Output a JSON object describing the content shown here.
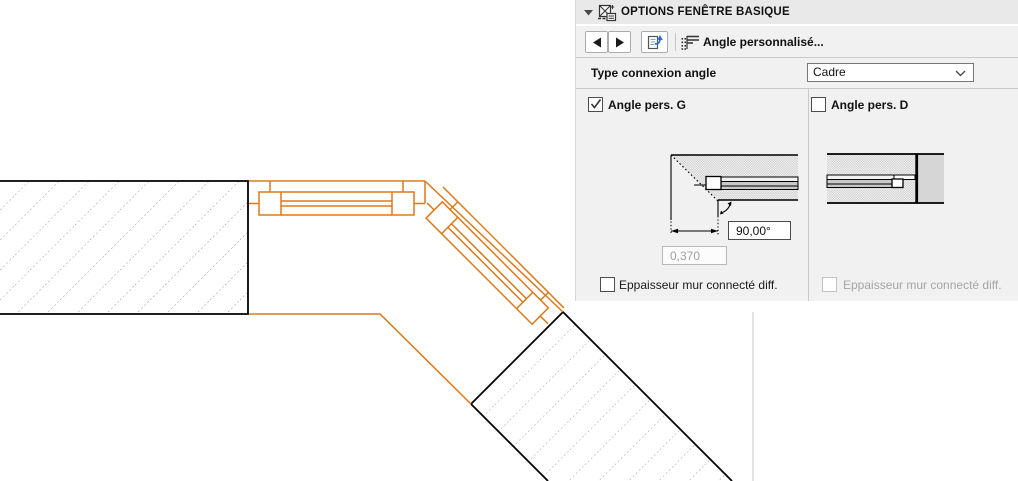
{
  "panel": {
    "header": {
      "title": "OPTIONS FENÊTRE BASIQUE"
    },
    "toolbar": {
      "prev_icon": "arrow-left-icon",
      "next_icon": "arrow-right-icon",
      "transfer_icon": "transfer-parameters-icon",
      "mode_icon": "custom-angle-icon",
      "mode_label": "Angle personnalisé..."
    },
    "connection": {
      "label": "Type connexion angle",
      "value": "Cadre"
    },
    "left_column": {
      "title": "Angle pers. G",
      "checked": true,
      "angle_value": "90,00°",
      "offset_value": "0,370",
      "offset_enabled": false,
      "thickness_label": "Eppaisseur mur connecté diff.",
      "thickness_checked": false
    },
    "right_column": {
      "title": "Angle pers. D",
      "checked": false,
      "thickness_label": "Eppaisseur mur connecté diff.",
      "thickness_enabled": false
    }
  },
  "drawing": {
    "description": "floor plan: two hatched walls meeting at 45° with two selected corner windows",
    "selection_color": "#e07818",
    "wall_outline_color": "#000000",
    "hatch_color": "#8f8f8f"
  },
  "colors": {
    "panel_bg": "#f1f1f1",
    "divider": "#c9c9c9",
    "accent_blue": "#2a6fd4",
    "disabled_text": "#a5a5a5"
  }
}
